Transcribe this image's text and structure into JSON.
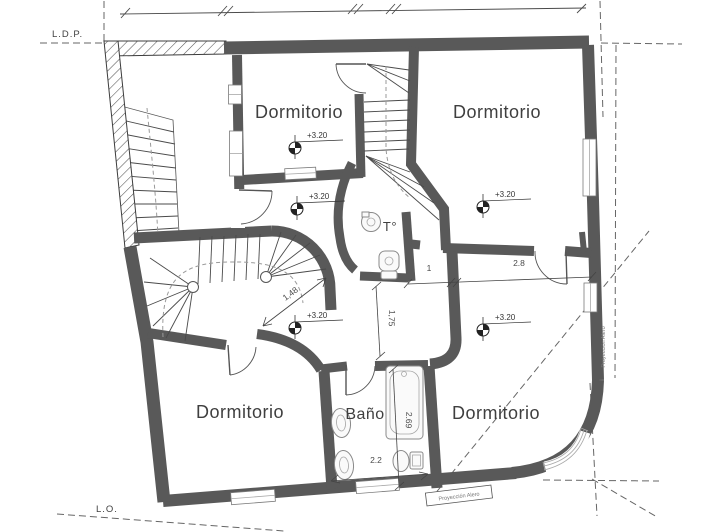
{
  "drawing": {
    "type": "floor-plan",
    "level_elevation": "+3.20"
  },
  "boundary": {
    "ldp": "L.D.P.",
    "lo": "L.O."
  },
  "rooms": [
    {
      "id": "bedroom-top-left",
      "label": "Dormitorio"
    },
    {
      "id": "bedroom-top-right",
      "label": "Dormitorio"
    },
    {
      "id": "bedroom-bottom-left",
      "label": "Dormitorio"
    },
    {
      "id": "bedroom-bottom-right",
      "label": "Dormitorio"
    },
    {
      "id": "bathroom",
      "label": "Baño"
    },
    {
      "id": "toilet",
      "label": "T°"
    }
  ],
  "elevation_markers": [
    {
      "label": "+3.20"
    },
    {
      "label": "+3.20"
    },
    {
      "label": "+3.20"
    },
    {
      "label": "+3.20"
    },
    {
      "label": "+3.20"
    }
  ],
  "dimensions": {
    "stair_diagonal": "1,48",
    "passage_vertical": "1,75",
    "hall_small": "1",
    "hall_large": "2.8",
    "bath_vertical": "2.69",
    "bath_horizontal": "2.2"
  },
  "projections": {
    "side": "Proyección Alero",
    "bottom": "Proyección Alero"
  },
  "colors": {
    "wall": "#595959",
    "line": "#4a4a4a",
    "text": "#3f3f3f",
    "muted": "#777777",
    "background": "#ffffff"
  }
}
